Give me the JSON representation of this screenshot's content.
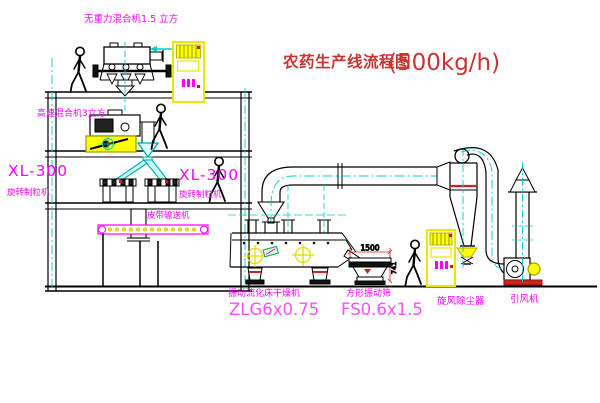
{
  "title": {
    "text": "农药生产线流程图",
    "capacity": "(500kg/h)"
  },
  "labels": {
    "gravity_mixer": "无重力混合机1.5 立方",
    "high_speed_mixer": "高速混合机3立方",
    "granulator_model_left": "XL-300",
    "granulator_name_left": "旋转制粒机",
    "granulator_model_right": "XL-300",
    "granulator_name_right": "旋转制粒机",
    "belt_conveyor": "皮带输送机",
    "dryer_name": "振动流化床干燥机",
    "dryer_model": "ZLG6x0.75",
    "sieve_name": "方形振动筛",
    "sieve_model": "FS0.6x1.5",
    "cyclone_name": "旋风除尘器",
    "fan_name": "引风机"
  },
  "dimensions": {
    "sieve_length": "1500",
    "sieve_height": "741"
  },
  "colors": {
    "background": "#ffffff",
    "line": "#000000",
    "label_magenta": "#ff00ff",
    "model_magenta": "#ff4dff",
    "title_red": "#cc3333",
    "accent_red": "#cc2222",
    "equipment_yellow": "#ffff00",
    "pipe_cyan": "#00cccc"
  }
}
